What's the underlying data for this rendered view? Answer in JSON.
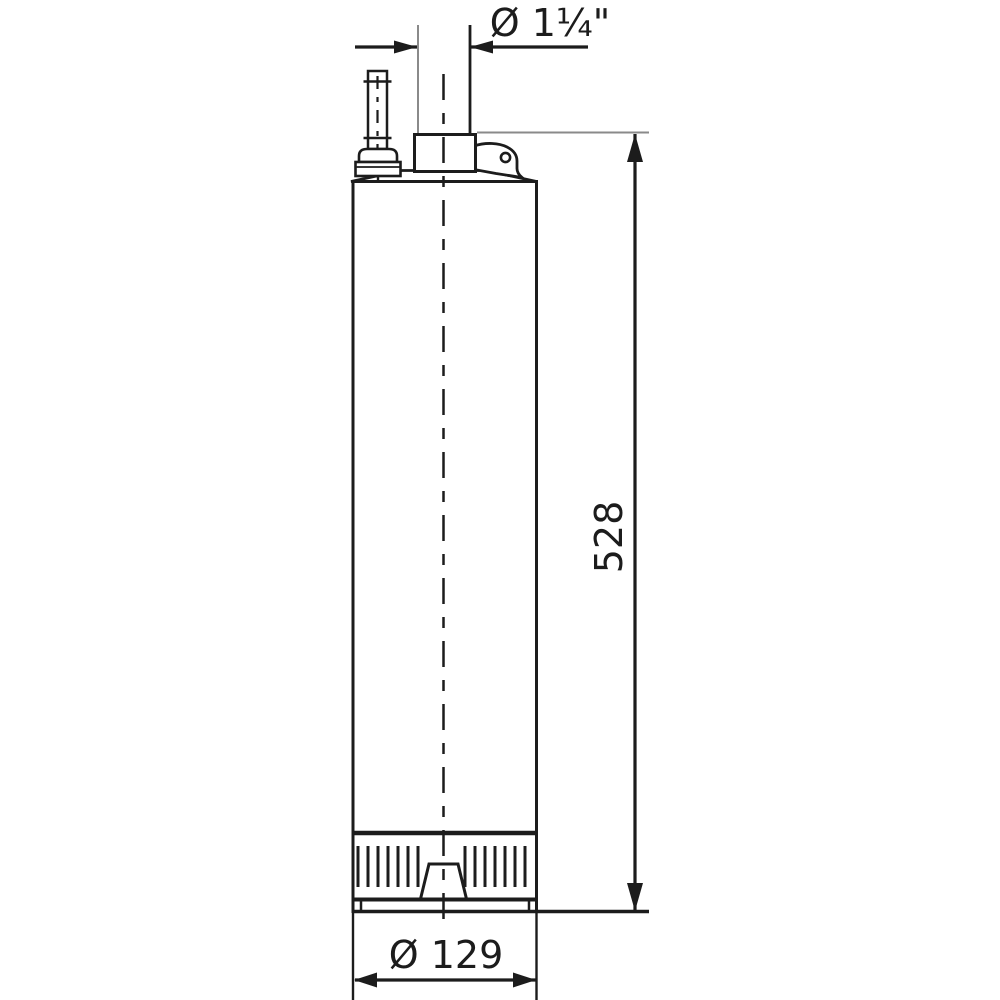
{
  "drawing": {
    "labels": {
      "top_diameter": "Ø 1¼\"",
      "height": "528",
      "bottom_diameter": "Ø 129"
    },
    "colors": {
      "line": "#1c1c1c",
      "extension_line": "#8a8a8a",
      "background": "#ffffff"
    }
  }
}
